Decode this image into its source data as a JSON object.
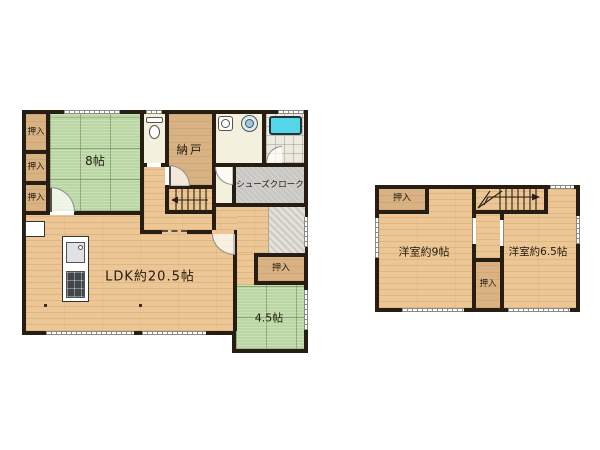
{
  "colors": {
    "wall": "#271d12",
    "wood": "#ecc795",
    "tan": "#d8b283",
    "tatami": "#b9d6a3",
    "cream": "#f4f0de",
    "gray_room": "#c8c7c3",
    "tile": "#e3e1da",
    "bath_floor": "#eceade",
    "tub": "#55d5e8",
    "label": "#221a10",
    "fixture_line": "#55524c"
  },
  "floor1": {
    "rooms": {
      "oshiire_top": {
        "label": "押入"
      },
      "oshiire_mid": {
        "label": "押入"
      },
      "oshiire_bottom": {
        "label": "押入"
      },
      "tatami8": {
        "label": "8帖"
      },
      "nando": {
        "label": "納戸"
      },
      "shoes_closet": {
        "label": "シューズクローク"
      },
      "ldk": {
        "label": "LDK約20.5帖"
      },
      "oshiire_entry": {
        "label": "押入"
      },
      "tatami45": {
        "label": "4.5帖"
      }
    }
  },
  "floor2": {
    "rooms": {
      "oshiire_left": {
        "label": "押入"
      },
      "western9": {
        "label": "洋室約9帖"
      },
      "western65": {
        "label": "洋室約6.5帖"
      },
      "oshiire_center": {
        "label": "押入"
      }
    }
  }
}
